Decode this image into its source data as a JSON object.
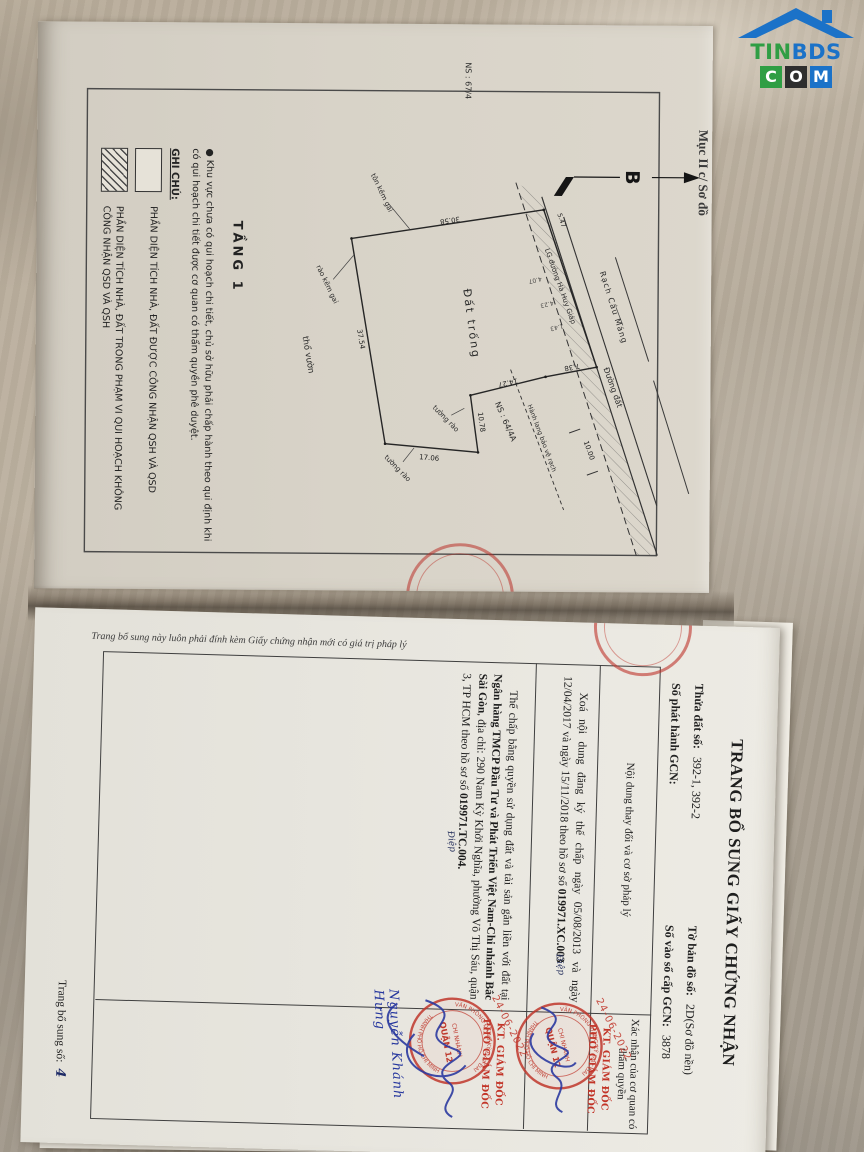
{
  "logo": {
    "tin": "TIN",
    "bds": "BDS",
    "boxes": [
      "C",
      "O",
      "M"
    ]
  },
  "map_page": {
    "margin_label": "Mục II c/ Sơ đồ",
    "north_label": "B",
    "floor_label": "TẦNG 1",
    "labels": {
      "canal": "Rạch Cầu Máng",
      "road_lg": "LG đường Hà Huy Giáp",
      "dirt_road": "Đường đất",
      "vacant": "Đất trống",
      "garden": "thổ vườn",
      "corridor": "Hành lang bảo vệ rạch",
      "house1": "NS : 67/4",
      "house2": "NS : 64/4A",
      "fence1": "tôn kẽm gai",
      "fence2": "rào kẽm gai",
      "wall1": "tường rào",
      "wall2": "tường rào"
    },
    "dims": {
      "d1": "30.58",
      "d2": "37.54",
      "d3": "17.06",
      "d4": "10.78",
      "d5": "14.27",
      "d6": "7.38",
      "d7": "10.00",
      "d8": "5.47",
      "s1": "4.07",
      "s2": "4.23",
      "s3": "1.43"
    },
    "legend": {
      "title": "GHI CHÚ:",
      "bullet": "●",
      "note": "Khu vực chưa có qui hoạch chi tiết, chủ sở hữu phải chấp hành theo qui định khi có qui hoạch chi tiết được cơ quan có thẩm quyền phê duyệt.",
      "item1": "PHẦN DIỆN TÍCH NHÀ, ĐẤT ĐƯỢC CÔNG NHẬN QSH VÀ QSD",
      "item2": "PHẦN DIỆN TÍCH NHÀ, ĐẤT TRONG PHẠM VI QUI HOẠCH KHÔNG CÔNG NHẬN QSD VÀ QSH"
    }
  },
  "supp_page": {
    "edge_note": "Trang bổ sung này luôn phải đính kèm Giấy chứng nhận mới có giá trị pháp lý",
    "title": "TRANG BỔ SUNG GIẤY CHỨNG NHẬN",
    "fields": {
      "parcel_label": "Thửa đất số:",
      "parcel_value": "392-1, 392-2",
      "sheet_label": "Tờ bản đồ số:",
      "sheet_value": "2D(Sơ đồ nền)",
      "issue_label": "Số phát hành GCN:",
      "issue_value": "",
      "book_label": "Số vào sổ cấp GCN:",
      "book_value": "3878"
    },
    "col1_header": "Nội dung thay đổi và cơ sở pháp lý",
    "col2_header": "Xác nhận của cơ quan có thẩm quyền",
    "entry1": {
      "t1": "Xoá nội dung đăng ký thế chấp ngày 05/08/2013 và ngày 12/04/2017 và ngày 15/11/2018 theo hồ sơ số ",
      "t2": "019971.XC.003",
      "initial": "Điệp"
    },
    "entry2": {
      "t1": "Thế chấp bằng quyền sử dụng đất và tài sản gắn liền với đất tại ",
      "t2": "Ngân hàng TMCP Đầu Tư và Phát Triển Việt Nam-Chi nhánh Bắc Sài Gòn",
      "t3": ", địa chỉ: 290 Nam Kỳ Khởi Nghĩa, phường Võ Thị Sáu, quận 3, TP HCM theo hồ sơ số ",
      "t4": "019971.TC.004.",
      "initial": "Điệp"
    },
    "approval1": {
      "date": "24-06-2022",
      "title1": "KT. GIÁM ĐỐC",
      "title2": "PHÓ GIÁM ĐỐC"
    },
    "approval2": {
      "date": "24-06-2022",
      "title1": "KT. GIÁM ĐỐC",
      "title2": "PHÓ GIÁM ĐỐC",
      "signer": "Nguyễn Khánh Hưng"
    },
    "stamp": {
      "ring_top": "VĂN PHÒNG ĐĂNG KÝ ĐẤT ĐAI",
      "ring_bottom": "THÀNH PHỐ HỒ CHÍ MINH",
      "center1": "CHI NHÁNH",
      "center2": "QUẬN 12"
    },
    "page_num_label": "Trang bổ sung số:",
    "page_num_value": "4"
  }
}
